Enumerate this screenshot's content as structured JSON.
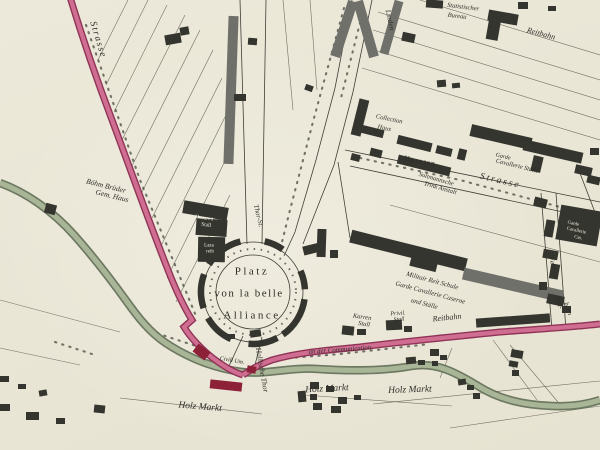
{
  "map": {
    "plaza": {
      "line1": "Platz",
      "line2": "von la belle",
      "line3": "Alliance"
    },
    "labels": [
      {
        "id": "strasse-nw",
        "text": "Strasse",
        "x": 97,
        "y": 40,
        "rot": 73,
        "size": 9.5,
        "italic": true,
        "ls": 1.5
      },
      {
        "id": "boehm-brueder-line1",
        "text": "Böhm Brüder",
        "x": 106,
        "y": 186,
        "rot": 14,
        "size": 7.5,
        "italic": true
      },
      {
        "id": "boehm-brueder-line2",
        "text": "Gem. Haus",
        "x": 112,
        "y": 196,
        "rot": 14,
        "size": 7.5,
        "italic": true
      },
      {
        "id": "husaren-stall-line1",
        "text": "Husaren",
        "x": 204,
        "y": 219,
        "rot": 8,
        "size": 5.5,
        "color": "white"
      },
      {
        "id": "husaren-stall-line2",
        "text": "Stall",
        "x": 206,
        "y": 226,
        "rot": 8,
        "size": 5.5,
        "color": "white"
      },
      {
        "id": "lazareth-line1",
        "text": "Laza",
        "x": 209,
        "y": 246,
        "rot": 0,
        "size": 5,
        "color": "white"
      },
      {
        "id": "lazareth-line2",
        "text": "reth",
        "x": 210,
        "y": 252,
        "rot": 0,
        "size": 5,
        "color": "white"
      },
      {
        "id": "thor-st",
        "text": "Thor-St.",
        "x": 258,
        "y": 216,
        "rot": 76,
        "size": 7,
        "italic": true
      },
      {
        "id": "hallische-thor",
        "text": "Hallische Thor",
        "x": 262,
        "y": 370,
        "rot": 80,
        "size": 7.5,
        "italic": true
      },
      {
        "id": "an-der-communication",
        "text": "an der Communication",
        "x": 340,
        "y": 351,
        "rot": -4,
        "size": 6.8,
        "italic": true
      },
      {
        "id": "holz-markt-west",
        "text": "Holz Markt",
        "x": 200,
        "y": 408,
        "rot": 5,
        "size": 9.5,
        "italic": true
      },
      {
        "id": "holz-markt-center",
        "text": "Holz Markt",
        "x": 327,
        "y": 390,
        "rot": -3,
        "size": 9.5,
        "italic": true
      },
      {
        "id": "holz-markt-east",
        "text": "Holz Markt",
        "x": 410,
        "y": 391,
        "rot": -2,
        "size": 9.5,
        "italic": true
      },
      {
        "id": "karren-stall-line1",
        "text": "Karren",
        "x": 362,
        "y": 318,
        "rot": 8,
        "size": 6.5,
        "italic": true
      },
      {
        "id": "karren-stall-line2",
        "text": "Stall",
        "x": 364,
        "y": 325,
        "rot": 8,
        "size": 6.5,
        "italic": true
      },
      {
        "id": "privil-stall-line1",
        "text": "Privil.",
        "x": 398,
        "y": 314,
        "rot": -4,
        "size": 6,
        "italic": true
      },
      {
        "id": "privil-stall-line2",
        "text": "Stall",
        "x": 399,
        "y": 320,
        "rot": -4,
        "size": 6,
        "italic": true
      },
      {
        "id": "reitbahn-mid",
        "text": "Reitbahn",
        "x": 447,
        "y": 318,
        "rot": -6,
        "size": 8,
        "italic": true
      },
      {
        "id": "militair-line1",
        "text": "Militair Reit Schule",
        "x": 432,
        "y": 282,
        "rot": 15,
        "size": 6.8,
        "italic": true
      },
      {
        "id": "militair-line2",
        "text": "Garde Cavallerie Caserne",
        "x": 430,
        "y": 294,
        "rot": 15,
        "size": 6.8,
        "italic": true
      },
      {
        "id": "militair-line3",
        "text": "und Ställe",
        "x": 424,
        "y": 305,
        "rot": 15,
        "size": 6.8,
        "italic": true
      },
      {
        "id": "feld",
        "text": "Feld",
        "x": 552,
        "y": 263,
        "rot": 80,
        "size": 7,
        "italic": true
      },
      {
        "id": "reitbahn-east-line1",
        "text": "Reit-",
        "x": 558,
        "y": 303,
        "rot": 72,
        "size": 6.5,
        "italic": true
      },
      {
        "id": "reitbahn-east-line2",
        "text": "bahn",
        "x": 567,
        "y": 309,
        "rot": 72,
        "size": 6.5,
        "italic": true
      },
      {
        "id": "garde-cav-cas-line1",
        "text": "Garde",
        "x": 573,
        "y": 225,
        "rot": 12,
        "size": 4.8,
        "color": "white"
      },
      {
        "id": "garde-cav-cas-line2",
        "text": "Cavallerie",
        "x": 576,
        "y": 232,
        "rot": 12,
        "size": 4.8,
        "color": "white"
      },
      {
        "id": "garde-cav-cas-line3",
        "text": "Cas.",
        "x": 578,
        "y": 239,
        "rot": 12,
        "size": 4.8,
        "color": "white"
      },
      {
        "id": "garde-cav-staelle-line1",
        "text": "Garde",
        "x": 503,
        "y": 157,
        "rot": 14,
        "size": 6,
        "italic": true
      },
      {
        "id": "garde-cav-staelle-line2",
        "text": "Cavallerie Ställe",
        "x": 517,
        "y": 167,
        "rot": 14,
        "size": 6.5,
        "italic": true
      },
      {
        "id": "strasse-east",
        "text": "Strasse",
        "x": 500,
        "y": 182,
        "rot": 13,
        "size": 9.5,
        "italic": true,
        "ls": 2
      },
      {
        "id": "husaren",
        "text": "Husaren",
        "x": 420,
        "y": 161,
        "rot": 10,
        "size": 7.5,
        "ls": 1
      },
      {
        "id": "soltmann-line1",
        "text": "Soltmannsche",
        "x": 436,
        "y": 180,
        "rot": 16,
        "size": 6.5,
        "italic": true
      },
      {
        "id": "soltmann-line2",
        "text": "Trink Anstalt",
        "x": 440,
        "y": 189,
        "rot": 16,
        "size": 6.5,
        "italic": true
      },
      {
        "id": "collection-line1",
        "text": "Collection",
        "x": 389,
        "y": 120,
        "rot": 12,
        "size": 6.5,
        "italic": true
      },
      {
        "id": "collection-line2",
        "text": "Haus",
        "x": 384,
        "y": 129,
        "rot": 12,
        "size": 6.5,
        "italic": true
      },
      {
        "id": "linden",
        "text": "Linden",
        "x": 390,
        "y": 20,
        "rot": 78,
        "size": 7.5,
        "italic": true
      },
      {
        "id": "statistischer-line1",
        "text": "Statistischer",
        "x": 463,
        "y": 8,
        "rot": 7,
        "size": 6.5,
        "italic": true
      },
      {
        "id": "statistischer-line2",
        "text": "Bureau",
        "x": 457,
        "y": 17,
        "rot": 7,
        "size": 6.5,
        "italic": true
      },
      {
        "id": "reitbahn-top",
        "text": "Reitbahn",
        "x": 541,
        "y": 34,
        "rot": 15,
        "size": 8,
        "italic": true
      },
      {
        "id": "civil-haus",
        "text": "Civill Um.",
        "x": 232,
        "y": 361,
        "rot": 10,
        "size": 6,
        "italic": true
      }
    ],
    "colors": {
      "paper": "#ebe8d9",
      "ink": "#3f3f36",
      "ink_light": "#5a5a4d",
      "building": "#35352f",
      "building_gray": "#70706a",
      "road": "#d06e92",
      "road_edge": "#8f3457",
      "gate": "#8c2138",
      "canal": "#a8b596",
      "canal_edge": "#5f6b54",
      "text": "#2e2e28",
      "label_white": "#eeebdd"
    }
  }
}
